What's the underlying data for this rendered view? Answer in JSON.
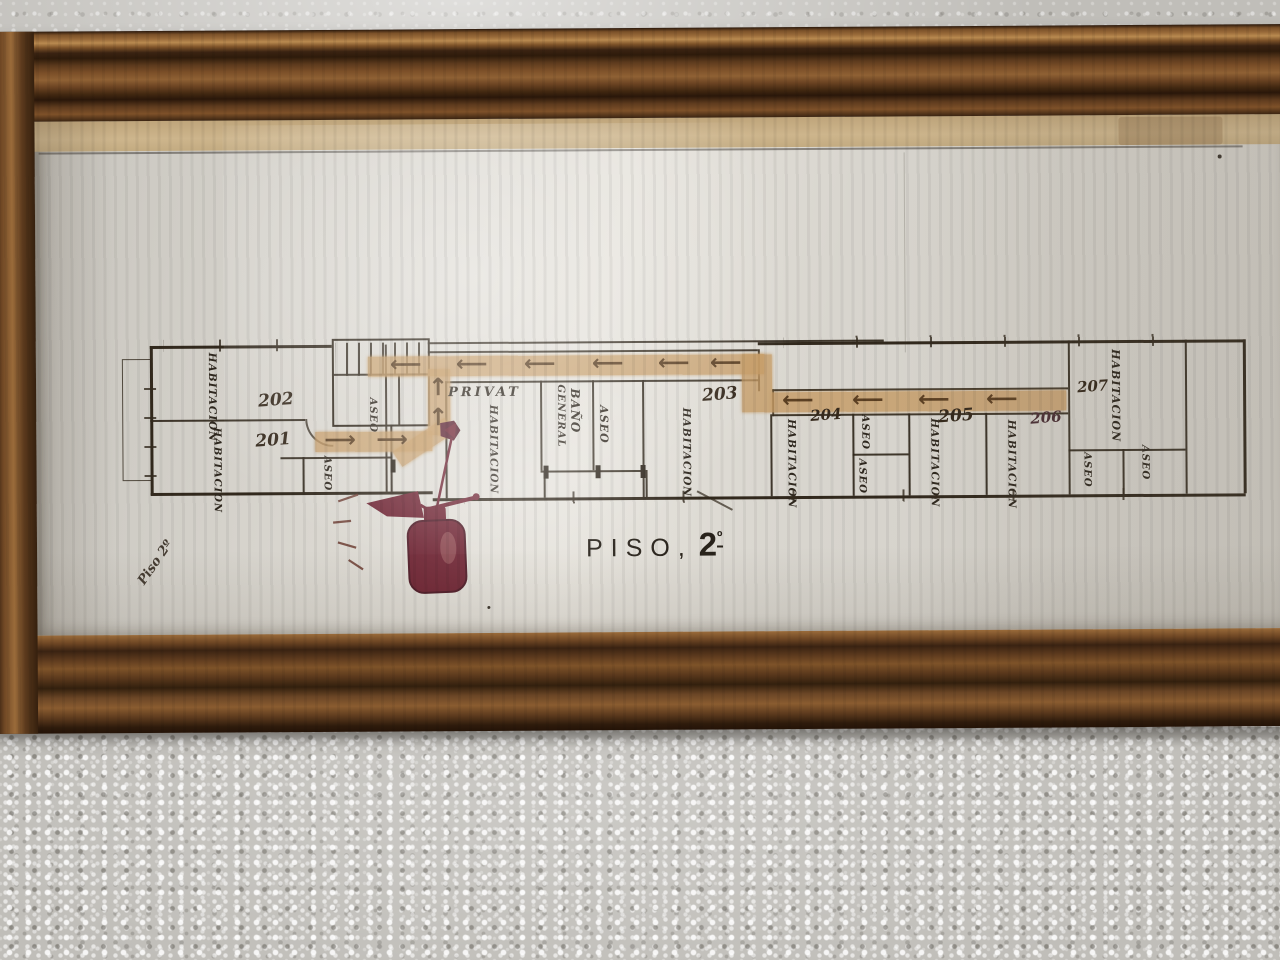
{
  "plan": {
    "title": {
      "word": "PISO,",
      "number": "2",
      "ordinal": "º"
    },
    "corner_note": "Piso 2º",
    "rooms": {
      "r201": {
        "number": "201",
        "label": "HABITACION"
      },
      "r202": {
        "number": "202",
        "label": "HABITACION"
      },
      "r203": {
        "number": "203",
        "label": "HABITACION"
      },
      "r204": {
        "number": "204",
        "label": "HABITACION"
      },
      "r205": {
        "number": "205",
        "label": "HABITACION"
      },
      "r206": {
        "number": "206",
        "label": "HABITACION"
      },
      "r207": {
        "number": "207",
        "label": "HABITACION"
      }
    },
    "privat": {
      "caption": "PRIVAT",
      "room_label": "HABITACION"
    },
    "bath": {
      "line1": "BAÑO",
      "line2": "GENERAL"
    },
    "aseo_label": "ASEO",
    "icons": {
      "arrow_left": "⟵",
      "arrow_right": "⟶",
      "arrow_up": "↑"
    },
    "colors": {
      "ink": "#32291d",
      "route_highlight": "#c49862",
      "extinguisher_red": "#6e2433",
      "frame_wood": "#6b4426",
      "paper": "#d9d6cf",
      "wall": "#c1bfba"
    }
  }
}
